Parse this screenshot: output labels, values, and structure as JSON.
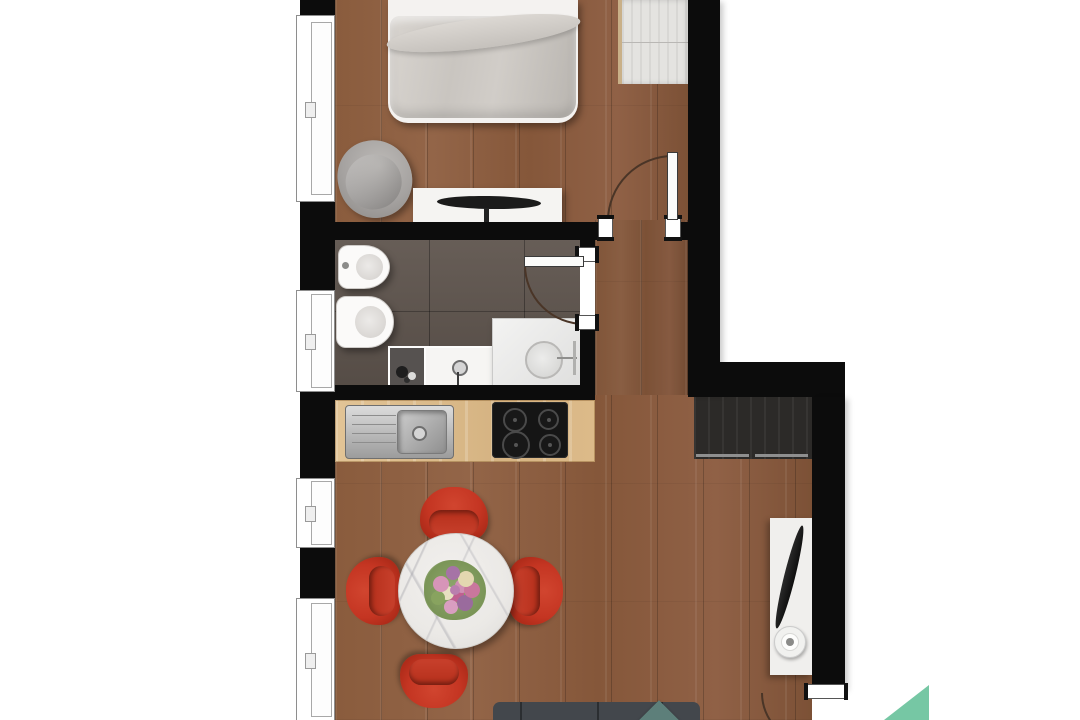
{
  "palette": {
    "bg": "#ffffff",
    "wall": "#0c0c0c",
    "wood": "#8a5c3d",
    "wood-dark": "#7c5136",
    "tile": "#5f554e",
    "counter": "#ddbd8e",
    "fixture": "#f3f2f0",
    "duvet": "#c8c4bf",
    "chair-gray": "#a5a2a0",
    "closet-dark": "#2c2a28",
    "chair-red": "#c43522",
    "chair-red-dark": "#9e2413",
    "marble": "#ebe9e6",
    "couch": "#43474c",
    "pillow-teal": "#5d7f7a",
    "steel": "#b9b9b9",
    "cooktop": "#151515",
    "logo-teal": "#76c7a4",
    "arc": "#4a3527"
  },
  "plan": {
    "type": "apartment-floor-plan-top-view",
    "rooms": [
      {
        "name": "bedroom",
        "floor": "wood",
        "furniture": [
          "double-bed",
          "lounge-chair",
          "console-table",
          "flat-tv",
          "wardrobe"
        ]
      },
      {
        "name": "bathroom",
        "floor": "dark-tile",
        "furniture": [
          "bidet",
          "toilet",
          "storage-box",
          "vanity-sink",
          "shower"
        ]
      },
      {
        "name": "hallway",
        "floor": "wood",
        "furniture": [
          "dark-closet"
        ]
      },
      {
        "name": "kitchen",
        "floor": "wood",
        "furniture": [
          "countertop",
          "stainless-sink",
          "induction-cooktop"
        ]
      },
      {
        "name": "living-dining",
        "floor": "wood",
        "furniture": [
          "round-marble-table",
          "flower-bouquet",
          "dining-chairs-x4",
          "sofa",
          "teal-pillow",
          "tv-stand",
          "flat-tv",
          "round-speaker"
        ]
      }
    ],
    "window_count": 4,
    "door_count": 3
  },
  "logo": {
    "shape": "right-triangle",
    "color": "#76c7a4"
  }
}
